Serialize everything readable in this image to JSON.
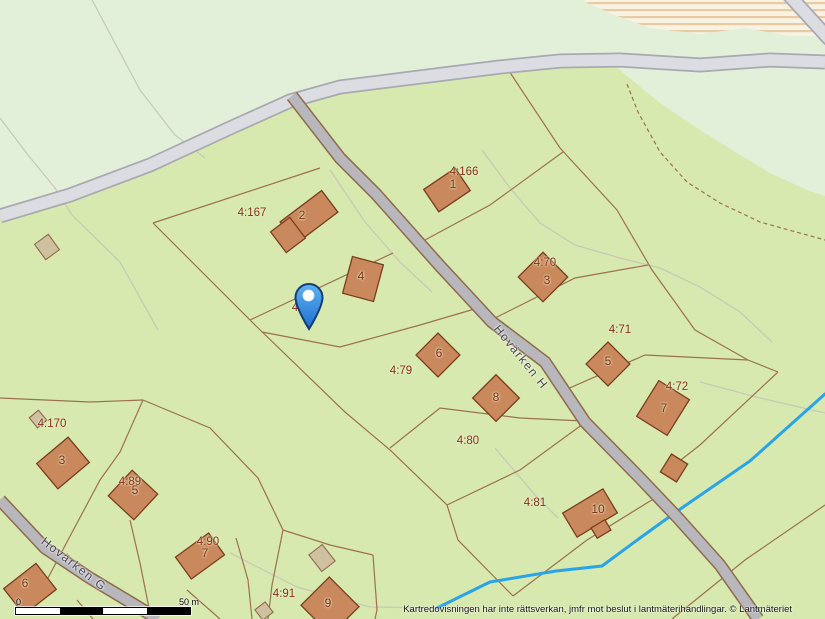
{
  "attribution": "Kartredovisningen har inte rättsverkan, jmfr mot beslut i lantmäterihandlingar. © Lantmäteriet",
  "scale_bar": {
    "start_label": "0",
    "end_label": "50 m"
  },
  "streets": [
    {
      "name": "Hovärken H"
    },
    {
      "name": "Hovärken G"
    }
  ],
  "parcels": [
    {
      "label": "4:167"
    },
    {
      "label": "4:166"
    },
    {
      "label": "4:70"
    },
    {
      "label": "4:71"
    },
    {
      "label": "4:72"
    },
    {
      "label": "4:78"
    },
    {
      "label": "4:79"
    },
    {
      "label": "4:80"
    },
    {
      "label": "4:81"
    },
    {
      "label": "4:170"
    },
    {
      "label": "4:89"
    },
    {
      "label": "4:90"
    },
    {
      "label": "4:91"
    }
  ],
  "building_numbers": [
    {
      "number": "1"
    },
    {
      "number": "2"
    },
    {
      "number": "3"
    },
    {
      "number": "4"
    },
    {
      "number": "5"
    },
    {
      "number": "6"
    },
    {
      "number": "7"
    },
    {
      "number": "8"
    },
    {
      "number": "9"
    },
    {
      "number": "10"
    },
    {
      "number": "3"
    },
    {
      "number": "5"
    },
    {
      "number": "7"
    },
    {
      "number": "6"
    }
  ],
  "marker": {
    "type": "location-pin",
    "color": "#2e86e4"
  },
  "colors": {
    "map_green": "#d7e9ae",
    "pale_green": "#e2f0da",
    "road_major_fill": "#dcdce3",
    "road_minor_fill": "#b7b7bc",
    "boundary_brown": "#9b7150",
    "building_orange": "#c9895d",
    "building_outline": "#7a3d1e",
    "shed_tan": "#cfc0a0",
    "parcel_label_red": "#8b2f1b",
    "stream_blue": "#29a3e9",
    "field_cream": "#f8f2e2",
    "field_stripe": "#e8cba3",
    "pin_blue": "#2e86e4"
  }
}
